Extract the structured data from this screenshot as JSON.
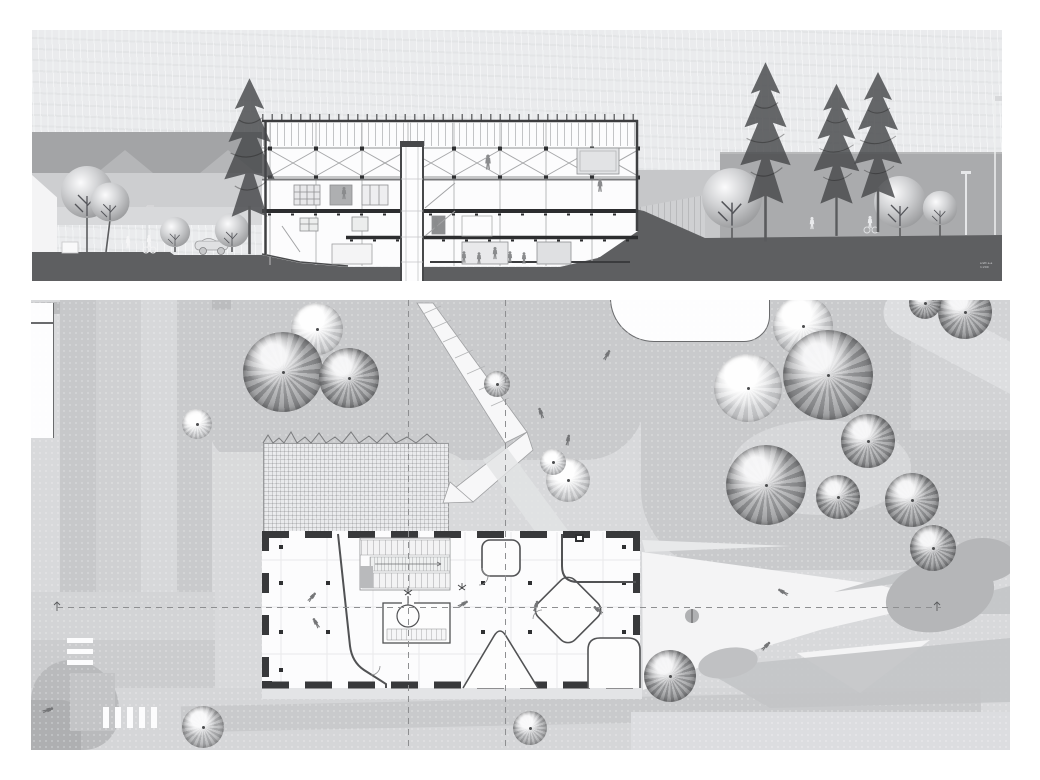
{
  "document": {
    "kind": "architectural presentation board",
    "panels": {
      "section": "building-section-elevation",
      "plan": "ground-floor-site-plan"
    }
  },
  "section_panel": {
    "scale_note": {
      "line1": "snitt a-a",
      "line2": "1:200"
    }
  },
  "plan_panel": {
    "axis_marker_left": "a",
    "axis_marker_right": "a"
  },
  "palette": {
    "paper": "#eaebed",
    "ground_dark": "#5e5f61",
    "background_building_gray": "#aaabad",
    "house_gray": "#b5b6b8",
    "plan_base": "#d8d9db",
    "grass_gray": "#c9cacc",
    "plaza_white": "#f4f4f5",
    "ink": "#3a3a3c"
  }
}
